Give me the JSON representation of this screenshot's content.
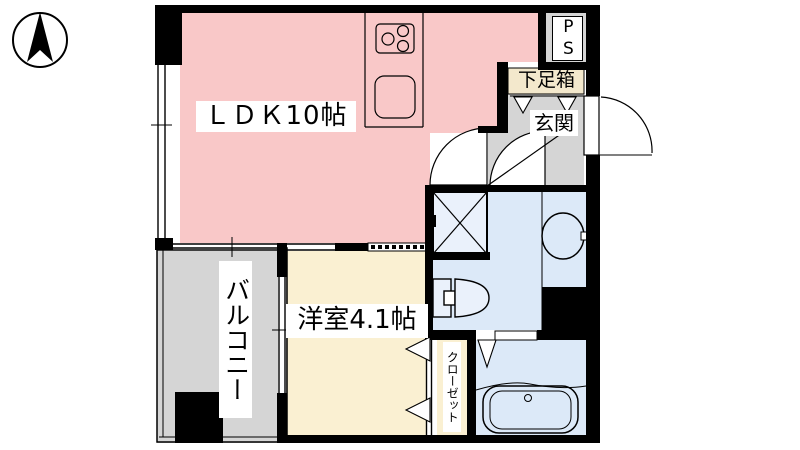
{
  "title": "apartment-floor-plan",
  "labels": {
    "ldk": "ＬＤＫ10帖",
    "western_room": "洋室4.1帖",
    "balcony": "バルコニー",
    "entrance": "玄関",
    "shoe_cabinet": "下足箱",
    "pipe_shaft": "PS",
    "closet": "クローゼット"
  },
  "colors": {
    "ldk": "#f9c8c8",
    "western_room": "#faf0d2",
    "closet": "#faf0d2",
    "wet_area": "#dce9f8",
    "fixture_fill": "#eaf1fb",
    "gray_area": "#d5d5d5",
    "shoe_cabinet": "#f3e8cc",
    "wall": "#000000"
  },
  "icons": {
    "compass": "north-arrow-icon",
    "stove": "three-burner-stove-icon",
    "sink": "kitchen-sink-icon",
    "washer": "washing-machine-pan-icon",
    "washbasin": "washbasin-icon",
    "toilet": "toilet-icon",
    "bathtub": "bathtub-icon"
  }
}
